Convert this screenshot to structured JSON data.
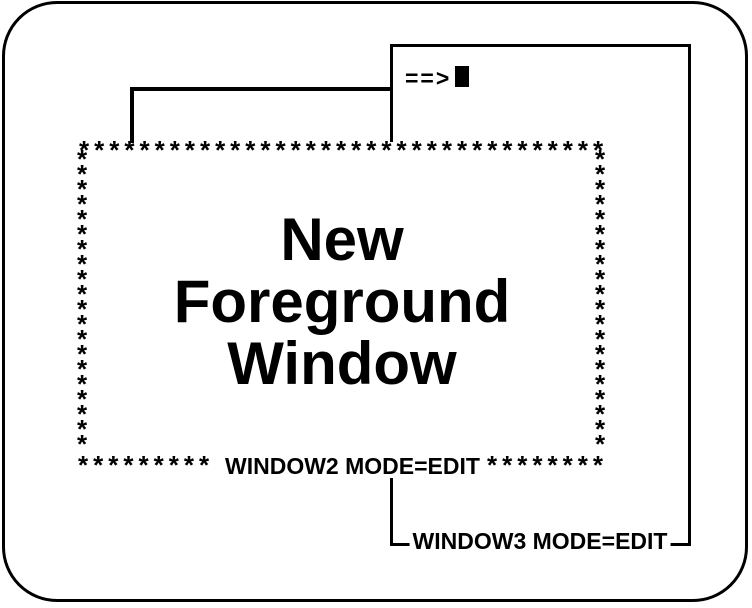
{
  "colors": {
    "ink": "#000000",
    "paper": "#ffffff"
  },
  "window3": {
    "prompt": "==>",
    "label": "WINDOW3 MODE=EDIT"
  },
  "window2": {
    "title_lines": [
      "New",
      "Foreground",
      "Window"
    ],
    "label": "WINDOW2 MODE=EDIT",
    "border_top": "***********************************",
    "border_side": "*\n*\n*\n*\n*\n*\n*\n*\n*\n*\n*\n*\n*\n*\n*\n*\n*\n*\n*\n*",
    "border_bottom_left": "*********",
    "border_bottom_right": "********"
  }
}
